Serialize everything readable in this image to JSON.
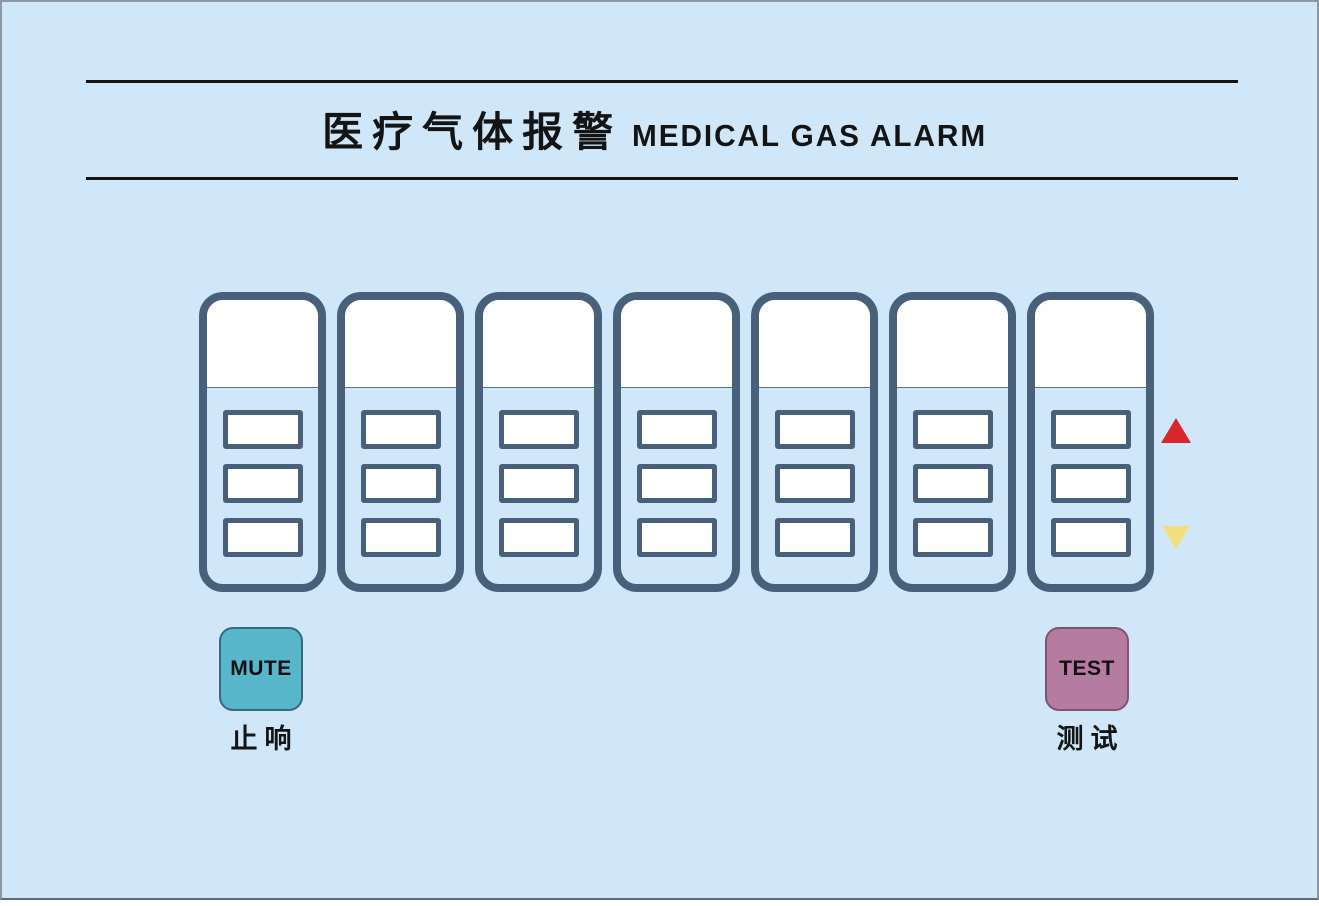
{
  "page": {
    "background_color": "#cfe7f8",
    "frame_border_color": "#8d98a2",
    "bottom_strip_color": "#ffffff"
  },
  "header": {
    "title_zh": "医疗气体报警",
    "title_en": "MEDICAL GAS ALARM",
    "rule_color": "#141414"
  },
  "channels": {
    "count": 7,
    "slots_per_panel": 3,
    "panel_border_color": "#48607a",
    "display_window_color": "#ffffff",
    "items": [
      {
        "name": "channel-1"
      },
      {
        "name": "channel-2"
      },
      {
        "name": "channel-3"
      },
      {
        "name": "channel-4"
      },
      {
        "name": "channel-5"
      },
      {
        "name": "channel-6"
      },
      {
        "name": "channel-7"
      }
    ]
  },
  "indicators": {
    "high": {
      "shape": "triangle-up",
      "color": "#d9262b"
    },
    "low": {
      "shape": "triangle-down",
      "color": "#f1df7e"
    }
  },
  "controls": {
    "mute": {
      "label": "MUTE",
      "caption_zh": "止响",
      "color": "#58b6cb"
    },
    "test": {
      "label": "TEST",
      "caption_zh": "测试",
      "color": "#b57ba0"
    }
  }
}
